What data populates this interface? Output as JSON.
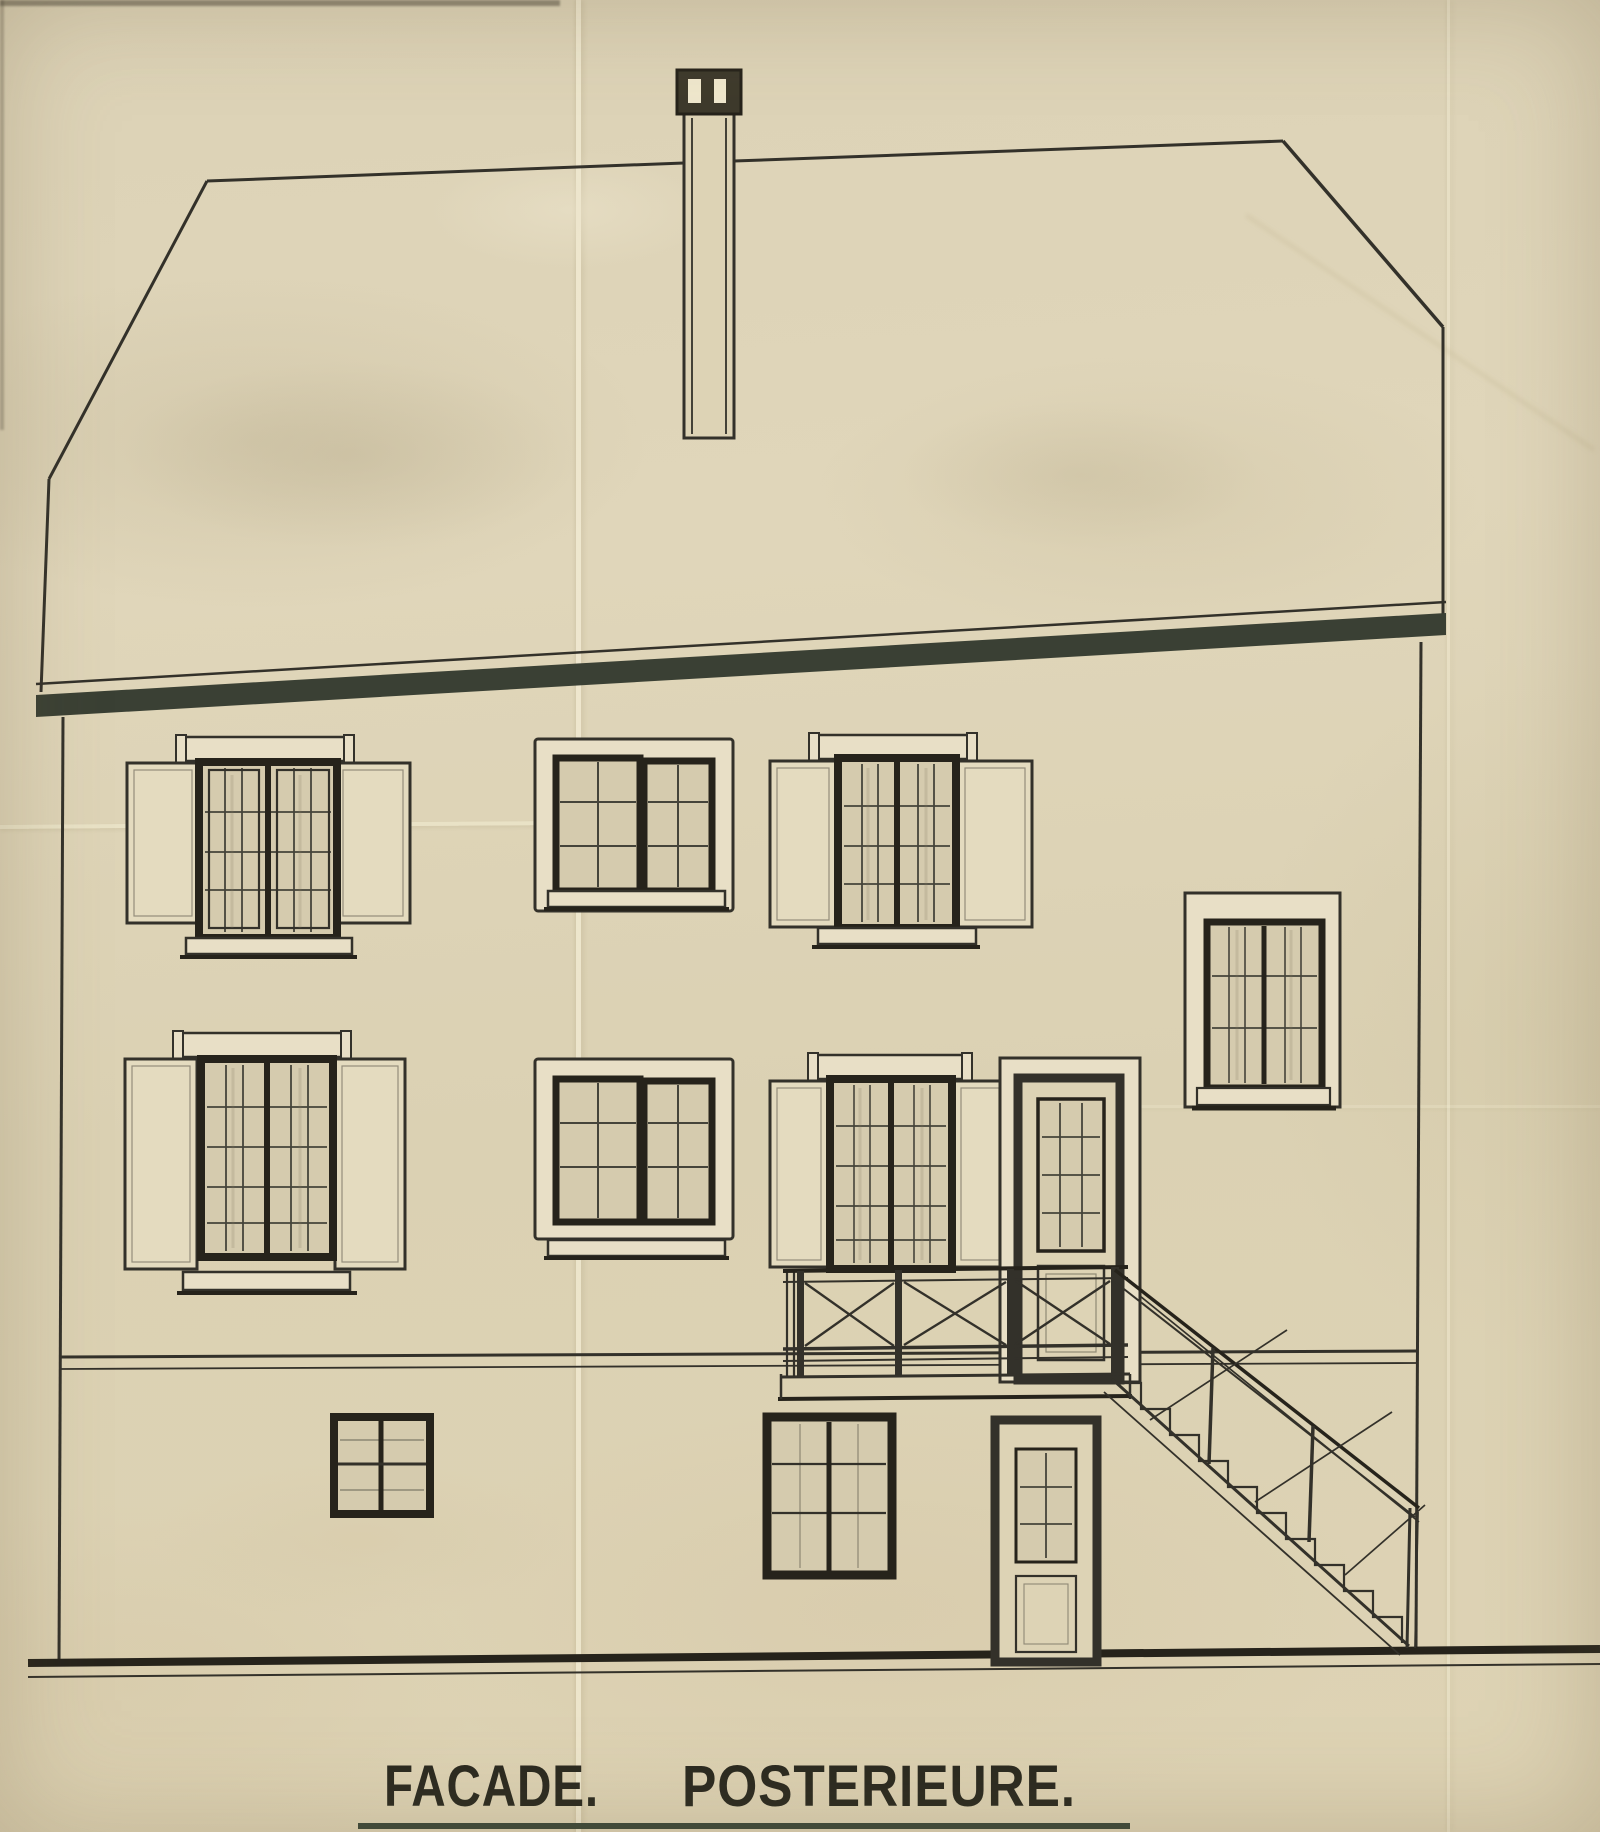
{
  "title": {
    "facade": "FACADE.",
    "posterieure": "POSTERIEURE.",
    "full": "FACADE POSTERIEURE."
  },
  "colors": {
    "paper": "#ddd3b5",
    "paper_light": "#efe7cd",
    "paper_shade": "#cfc4a5",
    "ink": "#33312a",
    "ink_heavy": "#26231b",
    "eaves": "#3a4034",
    "glass": "#d5cbae",
    "shutter": "#e4dbbf",
    "trim": "#e8dfc6",
    "underline": "#3c4839",
    "text": "#2b2a20"
  }
}
